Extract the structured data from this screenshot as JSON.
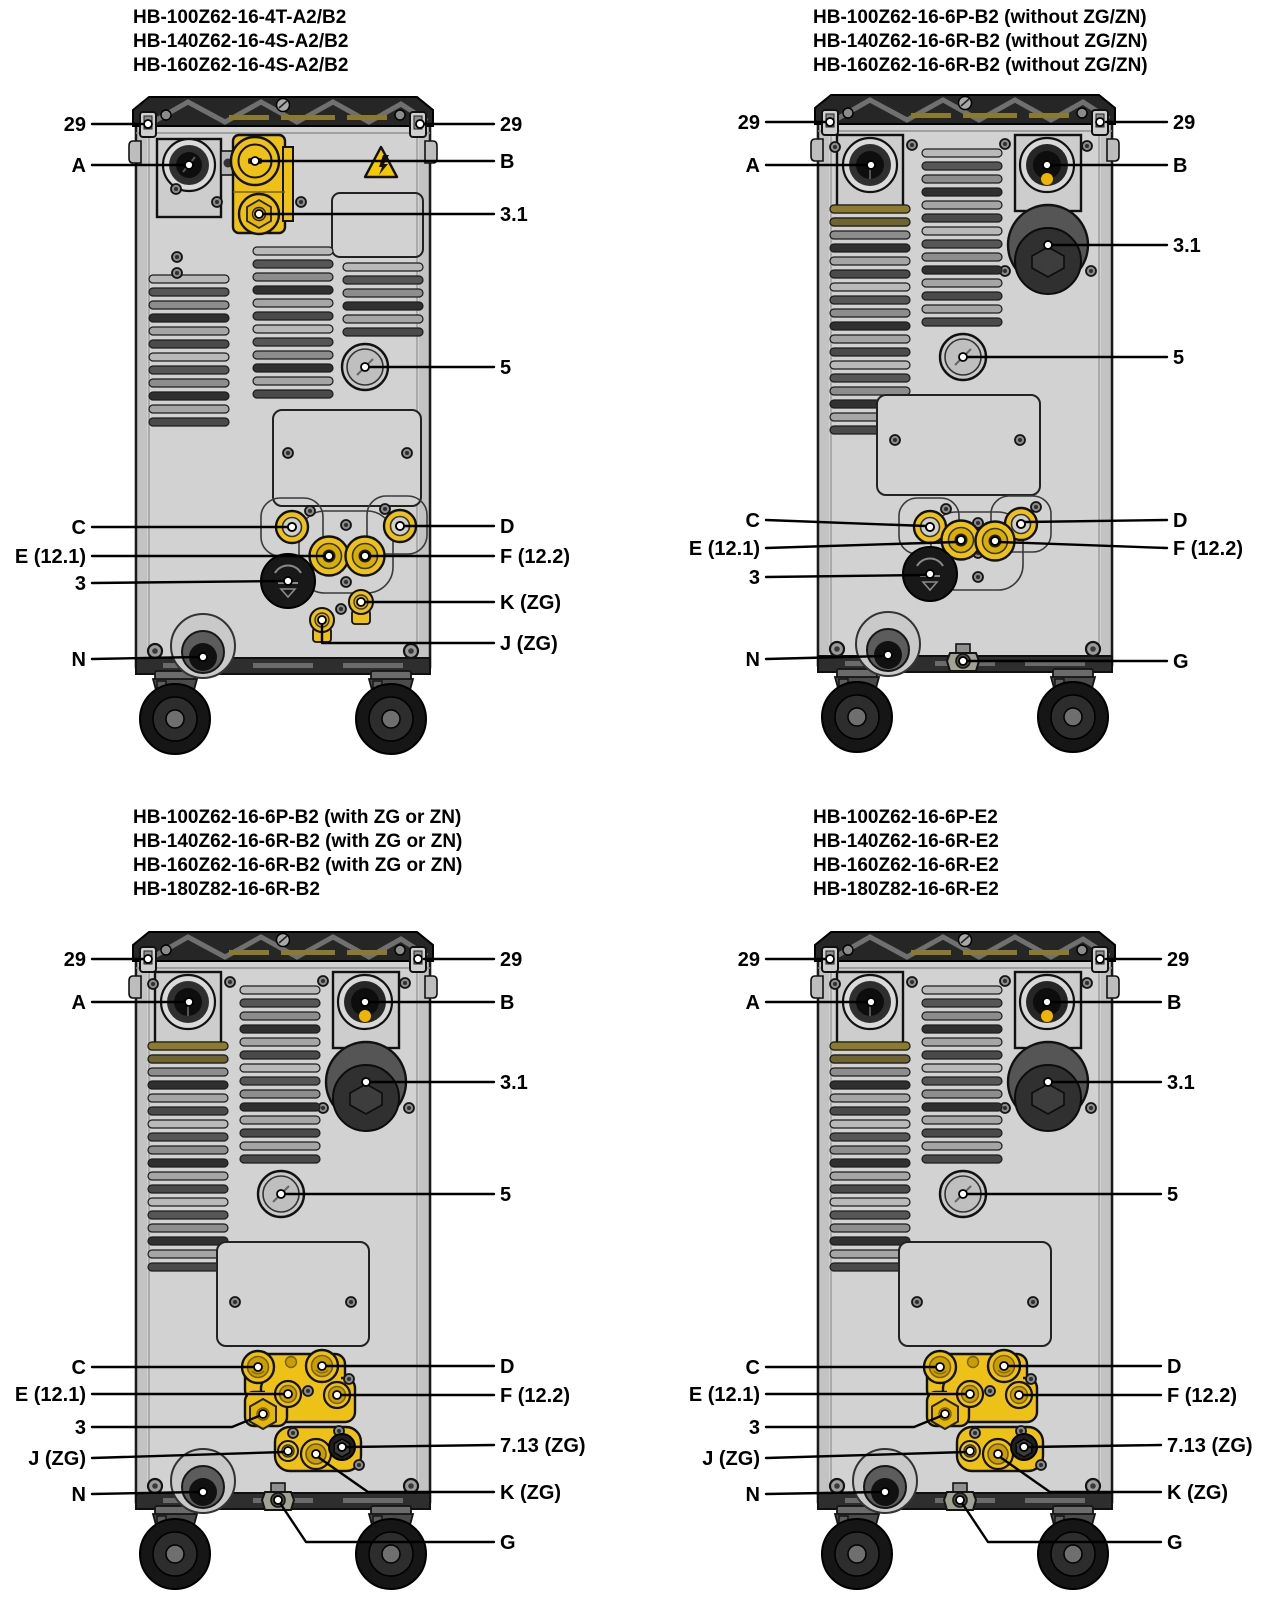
{
  "colors": {
    "accent_yellow": "#eec117",
    "cabinet_gray": "#d2d2d2",
    "top_cap_dark": "#262626",
    "line_black": "#000000"
  },
  "panels": [
    {
      "titles": [
        "HB-100Z62-16-4T-A2/B2",
        "HB-140Z62-16-4S-A2/B2",
        "HB-160Z62-16-4S-A2/B2"
      ],
      "labels": {
        "hook_left": "29",
        "hook_right": "29",
        "a": "A",
        "b": "B",
        "relief": "3.1",
        "cap": "5",
        "c": "C",
        "d": "D",
        "e": "E (12.1)",
        "f": "F (12.2)",
        "filter": "3",
        "k": "K (ZG)",
        "j": "J (ZG)",
        "n": "N"
      }
    },
    {
      "titles": [
        "HB-100Z62-16-6P-B2 (without ZG/ZN)",
        "HB-140Z62-16-6R-B2 (without ZG/ZN)",
        "HB-160Z62-16-6R-B2 (without ZG/ZN)"
      ],
      "labels": {
        "hook_left": "29",
        "hook_right": "29",
        "a": "A",
        "b": "B",
        "relief": "3.1",
        "cap": "5",
        "c": "C",
        "d": "D",
        "e": "E (12.1)",
        "f": "F (12.2)",
        "filter": "3",
        "n": "N",
        "g": "G"
      }
    },
    {
      "titles": [
        "HB-100Z62-16-6P-B2 (with ZG or ZN)",
        "HB-140Z62-16-6R-B2 (with ZG or ZN)",
        "HB-160Z62-16-6R-B2 (with ZG or ZN)",
        "HB-180Z82-16-6R-B2"
      ],
      "labels": {
        "hook_left": "29",
        "hook_right": "29",
        "a": "A",
        "b": "B",
        "relief": "3.1",
        "cap": "5",
        "c": "C",
        "d": "D",
        "e": "E (12.1)",
        "f": "F (12.2)",
        "filter": "3",
        "j": "J (ZG)",
        "x713": "7.13 (ZG)",
        "k": "K (ZG)",
        "n": "N",
        "g": "G"
      }
    },
    {
      "titles": [
        "HB-100Z62-16-6P-E2",
        "HB-140Z62-16-6R-E2",
        "HB-160Z62-16-6R-E2",
        "HB-180Z82-16-6R-E2"
      ],
      "labels": {
        "hook_left": "29",
        "hook_right": "29",
        "a": "A",
        "b": "B",
        "relief": "3.1",
        "cap": "5",
        "c": "C",
        "d": "D",
        "e": "E (12.1)",
        "f": "F (12.2)",
        "filter": "3",
        "j": "J (ZG)",
        "x713": "7.13 (ZG)",
        "k": "K (ZG)",
        "n": "N",
        "g": "G"
      }
    }
  ]
}
